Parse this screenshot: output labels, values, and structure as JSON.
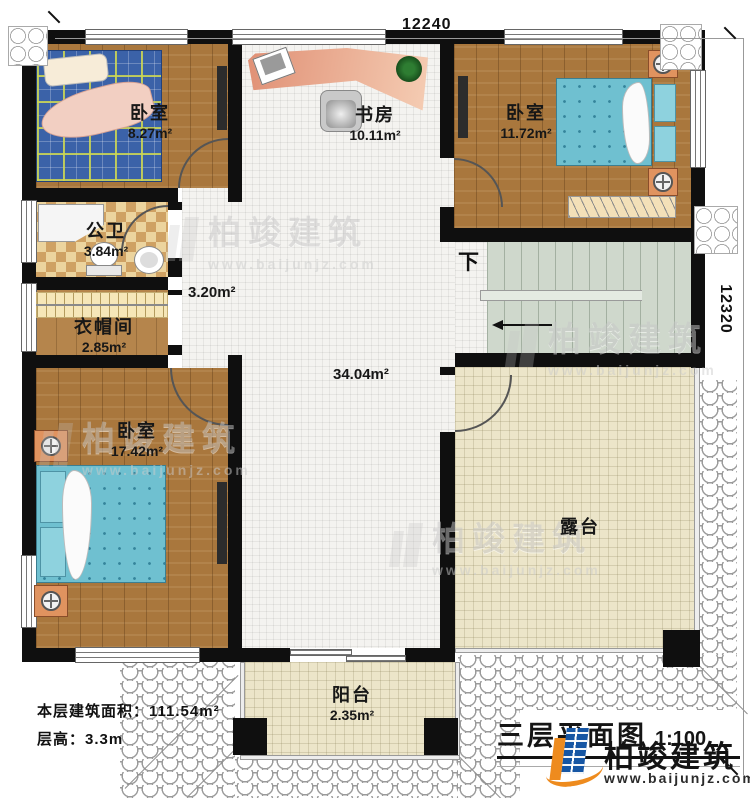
{
  "plan": {
    "title": "三层平面图",
    "scale": "1:100"
  },
  "dimensions": {
    "top": "12240",
    "right": "12320"
  },
  "rooms": {
    "bedroom_top_left": {
      "name": "卧室",
      "area": "8.27m²"
    },
    "study": {
      "name": "书房",
      "area": "10.11m²"
    },
    "bedroom_top_right": {
      "name": "卧室",
      "area": "11.72m²"
    },
    "bathroom": {
      "name": "公卫",
      "area": "3.84m²"
    },
    "cloakroom": {
      "name": "衣帽间",
      "area": "2.85m²"
    },
    "bedroom_bottom": {
      "name": "卧室",
      "area": "17.42m²"
    },
    "terrace": {
      "name": "露台"
    },
    "balcony": {
      "name": "阳台",
      "area": "2.35m²"
    }
  },
  "hall": {
    "upper_area": "3.20m²",
    "main_area": "34.04m²"
  },
  "stairs": {
    "down_label": "下"
  },
  "info": {
    "floor_area_label": "本层建筑面积：",
    "floor_area_value": "111.54m²",
    "floor_height_label": "层高：",
    "floor_height_value": "3.3m"
  },
  "branding": {
    "name": "柏竣建筑",
    "website": "www.baijunjz.com"
  },
  "colors": {
    "wall": "#0f0f0f",
    "wood": "#a9773d",
    "bed_teal": "#6fc0d0",
    "terrace": "#ece5c9",
    "stairs": "#cfd8cc",
    "logo_blue": "#1656a4",
    "logo_orange": "#ee8b1e"
  }
}
